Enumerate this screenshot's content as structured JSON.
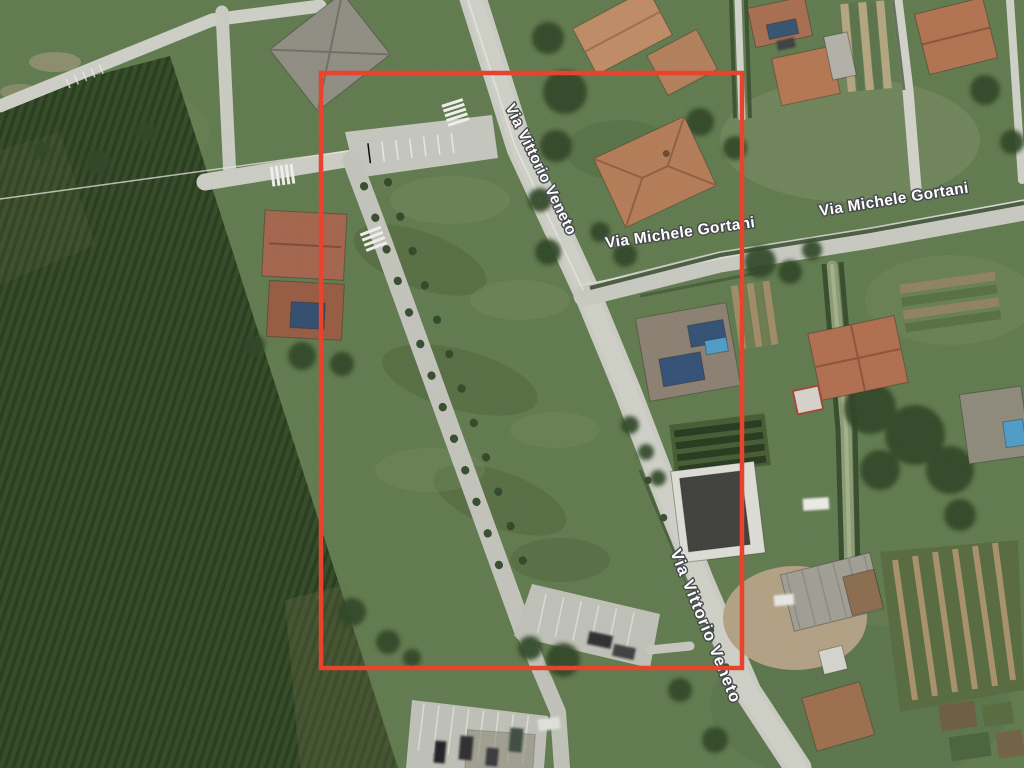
{
  "map": {
    "view_type": "satellite",
    "road_labels": [
      {
        "id": "via-vittorio-veneto-north",
        "text": "Via Vittorio Veneto"
      },
      {
        "id": "via-michele-gortani-west",
        "text": "Via Michele Gortani"
      },
      {
        "id": "via-michele-gortani-east",
        "text": "Via Michele Gortani"
      },
      {
        "id": "via-vittorio-veneto-south",
        "text": "Via Vittorio Veneto"
      }
    ],
    "annotation": {
      "shape": "rectangle",
      "color": "#e8432c"
    },
    "label_style": {
      "text_color": "#ffffff",
      "outline_color": "#474a4d"
    }
  }
}
